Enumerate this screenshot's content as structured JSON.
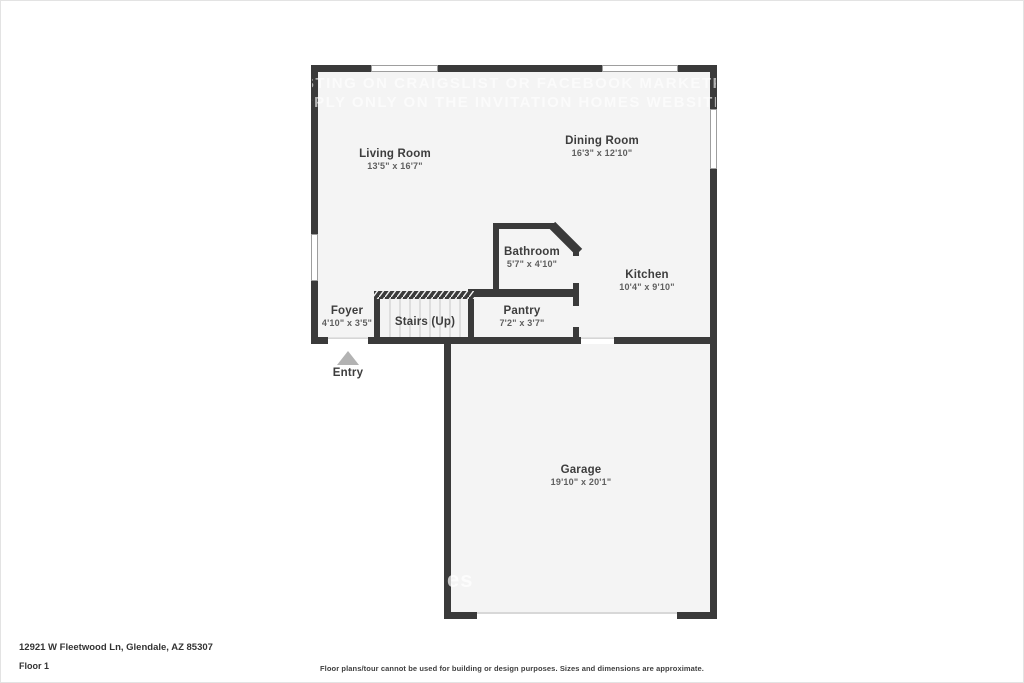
{
  "floorplan": {
    "watermark": {
      "line1": "STING ON CRAIGSLIST OR FACEBOOK MARKETP",
      "line2": "PPLY ONLY ON THE INVITATION HOMES WEBSITE",
      "partial": "es"
    },
    "rooms": [
      {
        "name": "Living Room",
        "dims": "13'5\" x 16'7\""
      },
      {
        "name": "Dining Room",
        "dims": "16'3\" x 12'10\""
      },
      {
        "name": "Bathroom",
        "dims": "5'7\" x 4'10\""
      },
      {
        "name": "Kitchen",
        "dims": "10'4\" x 9'10\""
      },
      {
        "name": "Foyer",
        "dims": "4'10\" x 3'5\""
      },
      {
        "name": "Stairs (Up)",
        "dims": ""
      },
      {
        "name": "Pantry",
        "dims": "7'2\" x 3'7\""
      },
      {
        "name": "Garage",
        "dims": "19'10\" x 20'1\""
      }
    ],
    "entry_label": "Entry"
  },
  "footer": {
    "address": "12921 W Fleetwood Ln, Glendale, AZ 85307",
    "floor_label": "Floor 1",
    "disclaimer": "Floor plans/tour cannot be used for building or design purposes. Sizes and dimensions are approximate."
  },
  "colors": {
    "wall": "#3a3a3a",
    "room_fill": "#f4f4f4",
    "window_fill": "#ffffff"
  }
}
